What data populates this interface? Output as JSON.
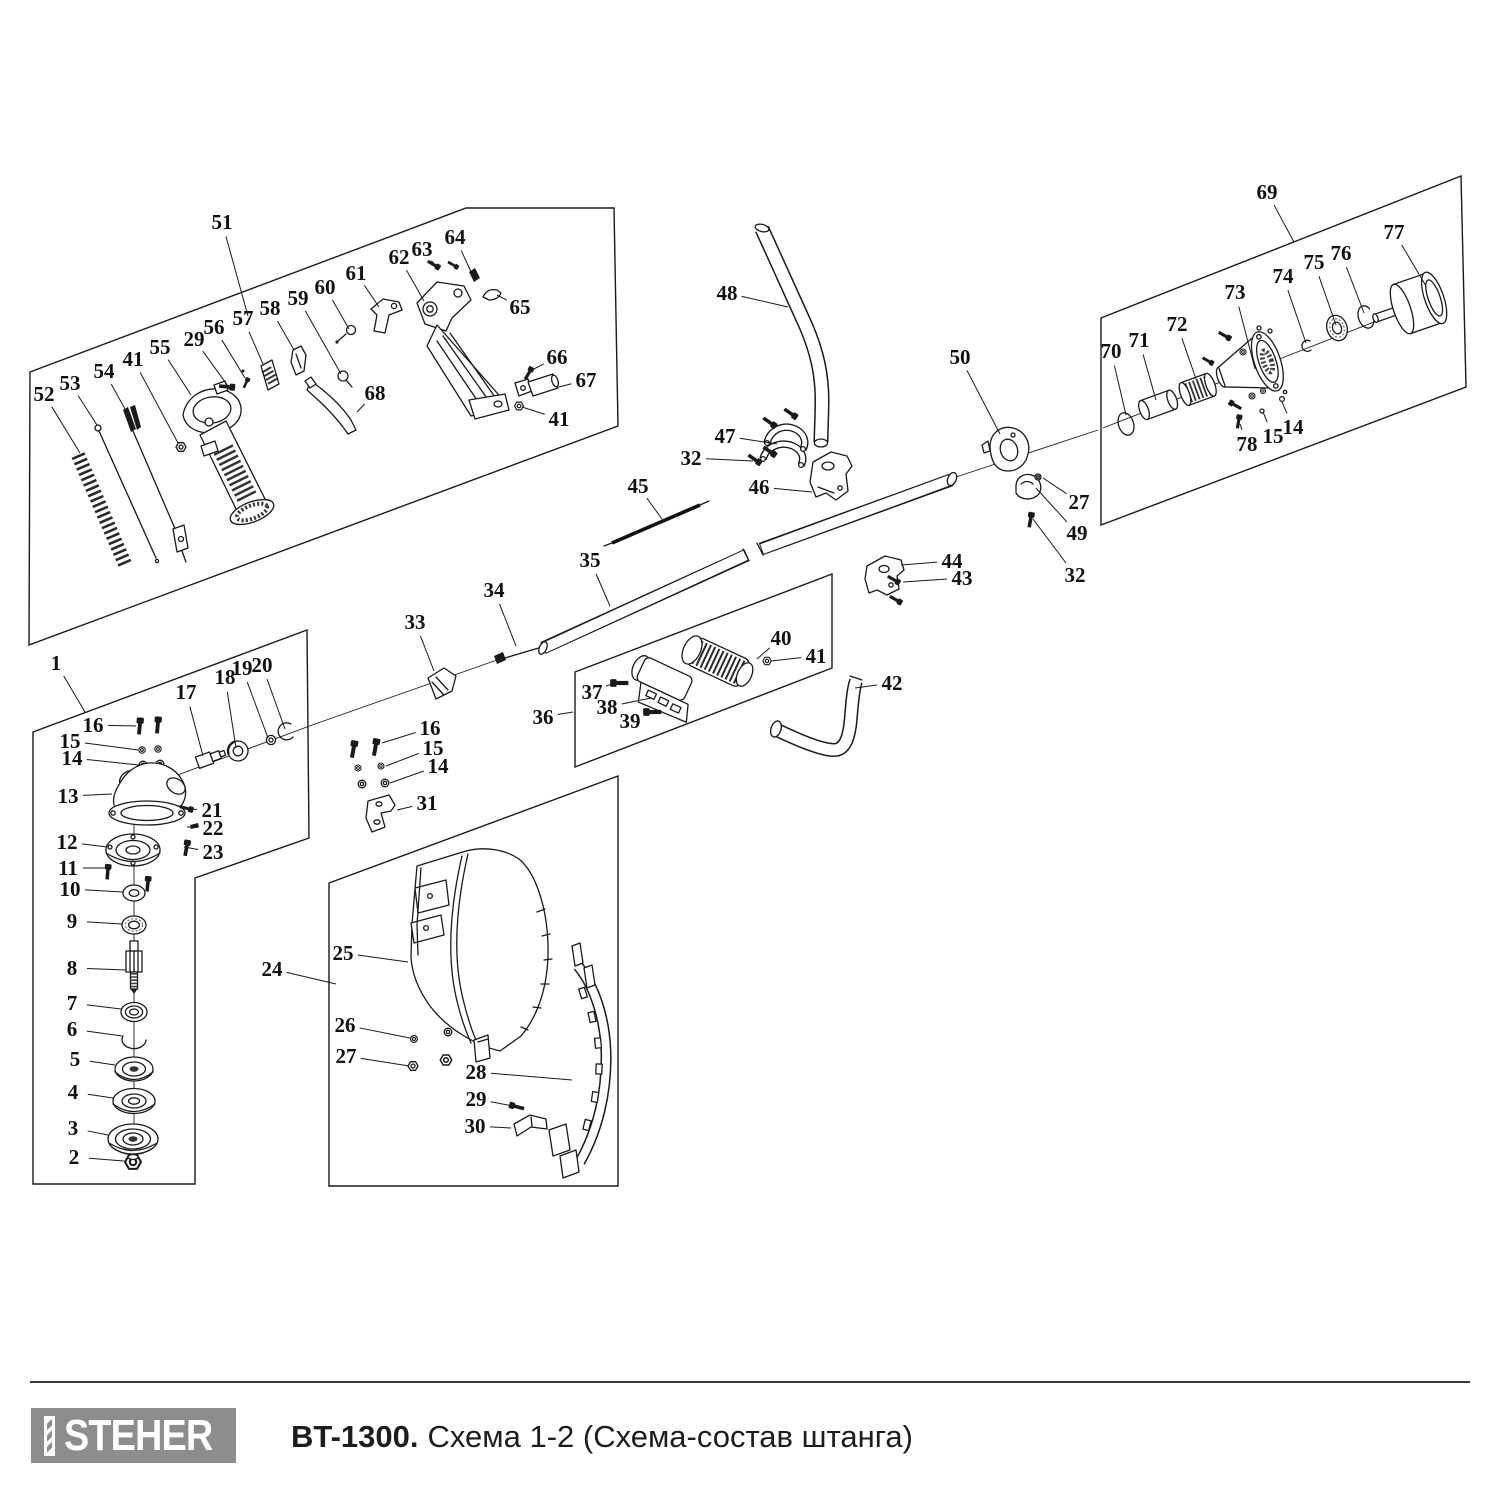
{
  "footer": {
    "brand": "STEHER",
    "model": "BT-1300.",
    "subtitle": "Схема 1-2 (Схема-состав штанга)"
  },
  "colors": {
    "line": "#1a1a1a",
    "logo_bg": "#8d8d8d",
    "label": "#111111"
  },
  "diagram": {
    "boxes": [
      {
        "name": "handle-assembly",
        "points": "30,372 466,208 614,208 618,426 29,645"
      },
      {
        "name": "gearhead-assembly",
        "points": "33,732 307,630 309,838 195,878 195,1184 33,1184"
      },
      {
        "name": "guard-assembly",
        "points": "329,883 618,776 618,1186 329,1186"
      },
      {
        "name": "grip-assembly",
        "points": "575,672 832,574 832,668 575,767"
      },
      {
        "name": "clutch-assembly",
        "points": "1101,318 1461,176 1466,387 1101,525"
      }
    ],
    "axes": [
      "148,786 315,724",
      "315,724 497,660",
      "953,478 1098,430",
      "1103,428 1420,304",
      "134,822 134,1152"
    ],
    "callouts": [
      {
        "t": "51",
        "x": 222,
        "y": 222,
        "tx": 248,
        "ty": 316
      },
      {
        "t": "52",
        "x": 44,
        "y": 394,
        "tx": 80,
        "ty": 453
      },
      {
        "t": "53",
        "x": 70,
        "y": 383,
        "tx": 97,
        "ty": 425
      },
      {
        "t": "54",
        "x": 104,
        "y": 371,
        "tx": 125,
        "ty": 409
      },
      {
        "t": "41",
        "x": 133,
        "y": 359,
        "tx": 178,
        "ty": 443
      },
      {
        "t": "55",
        "x": 160,
        "y": 347,
        "tx": 191,
        "ty": 395
      },
      {
        "t": "29",
        "x": 194,
        "y": 339,
        "tx": 228,
        "ty": 386
      },
      {
        "t": "56",
        "x": 214,
        "y": 327,
        "tx": 245,
        "ty": 378
      },
      {
        "t": "57",
        "x": 243,
        "y": 318,
        "tx": 263,
        "ty": 364
      },
      {
        "t": "58",
        "x": 270,
        "y": 308,
        "tx": 294,
        "ty": 350
      },
      {
        "t": "59",
        "x": 298,
        "y": 298,
        "tx": 341,
        "ty": 374
      },
      {
        "t": "60",
        "x": 325,
        "y": 287,
        "tx": 349,
        "ty": 329
      },
      {
        "t": "61",
        "x": 356,
        "y": 273,
        "tx": 379,
        "ty": 307
      },
      {
        "t": "62",
        "x": 399,
        "y": 257,
        "tx": 424,
        "ty": 301
      },
      {
        "t": "63",
        "x": 422,
        "y": 249,
        "tx": 435,
        "ty": 265
      },
      {
        "t": "64",
        "x": 455,
        "y": 237,
        "tx": 472,
        "ty": 274
      },
      {
        "t": "65",
        "x": 520,
        "y": 307,
        "tx": 497,
        "ty": 295
      },
      {
        "t": "66",
        "x": 557,
        "y": 357,
        "tx": 532,
        "ty": 370
      },
      {
        "t": "67",
        "x": 586,
        "y": 380,
        "tx": 559,
        "ty": 387
      },
      {
        "t": "41",
        "x": 559,
        "y": 419,
        "tx": 522,
        "ty": 407
      },
      {
        "t": "68",
        "x": 375,
        "y": 393,
        "tx": 357,
        "ty": 412
      },
      {
        "t": "1",
        "x": 56,
        "y": 663,
        "tx": 85,
        "ty": 712
      },
      {
        "t": "16",
        "x": 93,
        "y": 725,
        "tx": 136,
        "ty": 726
      },
      {
        "t": "15",
        "x": 70,
        "y": 741,
        "tx": 138,
        "ty": 750
      },
      {
        "t": "14",
        "x": 72,
        "y": 758,
        "tx": 139,
        "ty": 765
      },
      {
        "t": "17",
        "x": 186,
        "y": 692,
        "tx": 203,
        "ty": 756
      },
      {
        "t": "18",
        "x": 225,
        "y": 677,
        "tx": 236,
        "ty": 748
      },
      {
        "t": "19",
        "x": 242,
        "y": 668,
        "tx": 268,
        "ty": 738
      },
      {
        "t": "20",
        "x": 262,
        "y": 665,
        "tx": 285,
        "ty": 729
      },
      {
        "t": "13",
        "x": 68,
        "y": 796,
        "tx": 112,
        "ty": 794
      },
      {
        "t": "21",
        "x": 212,
        "y": 810,
        "tx": 186,
        "ty": 809
      },
      {
        "t": "22",
        "x": 213,
        "y": 828,
        "tx": 187,
        "ty": 827
      },
      {
        "t": "23",
        "x": 213,
        "y": 852,
        "tx": 184,
        "ty": 847
      },
      {
        "t": "12",
        "x": 67,
        "y": 842,
        "tx": 107,
        "ty": 847
      },
      {
        "t": "11",
        "x": 68,
        "y": 868,
        "tx": 105,
        "ty": 868
      },
      {
        "t": "10",
        "x": 70,
        "y": 889,
        "tx": 123,
        "ty": 892
      },
      {
        "t": "9",
        "x": 72,
        "y": 921,
        "tx": 122,
        "ty": 924
      },
      {
        "t": "8",
        "x": 72,
        "y": 968,
        "tx": 126,
        "ty": 970
      },
      {
        "t": "7",
        "x": 72,
        "y": 1003,
        "tx": 121,
        "ty": 1009
      },
      {
        "t": "6",
        "x": 72,
        "y": 1029,
        "tx": 122,
        "ty": 1036
      },
      {
        "t": "5",
        "x": 75,
        "y": 1059,
        "tx": 115,
        "ty": 1065
      },
      {
        "t": "4",
        "x": 73,
        "y": 1092,
        "tx": 113,
        "ty": 1098
      },
      {
        "t": "3",
        "x": 73,
        "y": 1128,
        "tx": 108,
        "ty": 1135
      },
      {
        "t": "2",
        "x": 74,
        "y": 1157,
        "tx": 124,
        "ty": 1161
      },
      {
        "t": "48",
        "x": 727,
        "y": 293,
        "tx": 788,
        "ty": 307
      },
      {
        "t": "45",
        "x": 638,
        "y": 486,
        "tx": 662,
        "ty": 519
      },
      {
        "t": "35",
        "x": 590,
        "y": 560,
        "tx": 610,
        "ty": 606
      },
      {
        "t": "34",
        "x": 494,
        "y": 590,
        "tx": 516,
        "ty": 646
      },
      {
        "t": "33",
        "x": 415,
        "y": 622,
        "tx": 434,
        "ty": 671
      },
      {
        "t": "47",
        "x": 725,
        "y": 436,
        "tx": 777,
        "ty": 444
      },
      {
        "t": "32",
        "x": 691,
        "y": 458,
        "tx": 753,
        "ty": 461
      },
      {
        "t": "46",
        "x": 759,
        "y": 487,
        "tx": 812,
        "ty": 492
      },
      {
        "t": "50",
        "x": 960,
        "y": 357,
        "tx": 1000,
        "ty": 434
      },
      {
        "t": "27",
        "x": 1079,
        "y": 502,
        "tx": 1043,
        "ty": 478
      },
      {
        "t": "49",
        "x": 1077,
        "y": 533,
        "tx": 1036,
        "ty": 488
      },
      {
        "t": "32",
        "x": 1075,
        "y": 575,
        "tx": 1033,
        "ty": 519
      },
      {
        "t": "44",
        "x": 952,
        "y": 561,
        "tx": 901,
        "ty": 565
      },
      {
        "t": "43",
        "x": 962,
        "y": 578,
        "tx": 903,
        "ty": 582
      },
      {
        "t": "42",
        "x": 892,
        "y": 683,
        "tx": 855,
        "ty": 688
      },
      {
        "t": "40",
        "x": 781,
        "y": 638,
        "tx": 757,
        "ty": 659
      },
      {
        "t": "41",
        "x": 816,
        "y": 656,
        "tx": 771,
        "ty": 661
      },
      {
        "t": "37",
        "x": 592,
        "y": 692,
        "tx": 614,
        "ty": 683
      },
      {
        "t": "38",
        "x": 607,
        "y": 707,
        "tx": 651,
        "ty": 698
      },
      {
        "t": "39",
        "x": 630,
        "y": 721,
        "tx": 651,
        "ty": 712
      },
      {
        "t": "36",
        "x": 543,
        "y": 717,
        "tx": 573,
        "ty": 712
      },
      {
        "t": "16",
        "x": 430,
        "y": 728,
        "tx": 382,
        "ty": 743
      },
      {
        "t": "15",
        "x": 433,
        "y": 748,
        "tx": 386,
        "ty": 766
      },
      {
        "t": "14",
        "x": 438,
        "y": 766,
        "tx": 390,
        "ty": 783
      },
      {
        "t": "31",
        "x": 427,
        "y": 803,
        "tx": 397,
        "ty": 810
      },
      {
        "t": "24",
        "x": 272,
        "y": 969,
        "tx": 336,
        "ty": 984
      },
      {
        "t": "25",
        "x": 343,
        "y": 953,
        "tx": 408,
        "ty": 962
      },
      {
        "t": "26",
        "x": 345,
        "y": 1025,
        "tx": 410,
        "ty": 1038
      },
      {
        "t": "27",
        "x": 346,
        "y": 1056,
        "tx": 409,
        "ty": 1066
      },
      {
        "t": "28",
        "x": 476,
        "y": 1072,
        "tx": 572,
        "ty": 1080
      },
      {
        "t": "29",
        "x": 476,
        "y": 1099,
        "tx": 513,
        "ty": 1106
      },
      {
        "t": "30",
        "x": 475,
        "y": 1126,
        "tx": 511,
        "ty": 1128
      },
      {
        "t": "69",
        "x": 1267,
        "y": 192,
        "tx": 1294,
        "ty": 242
      },
      {
        "t": "70",
        "x": 1111,
        "y": 351,
        "tx": 1126,
        "ty": 415
      },
      {
        "t": "71",
        "x": 1139,
        "y": 340,
        "tx": 1156,
        "ty": 400
      },
      {
        "t": "72",
        "x": 1177,
        "y": 324,
        "tx": 1196,
        "ty": 379
      },
      {
        "t": "73",
        "x": 1235,
        "y": 292,
        "tx": 1255,
        "ty": 369
      },
      {
        "t": "74",
        "x": 1283,
        "y": 276,
        "tx": 1306,
        "ty": 343
      },
      {
        "t": "75",
        "x": 1314,
        "y": 262,
        "tx": 1336,
        "ty": 325
      },
      {
        "t": "76",
        "x": 1341,
        "y": 253,
        "tx": 1364,
        "ty": 313
      },
      {
        "t": "77",
        "x": 1394,
        "y": 232,
        "tx": 1426,
        "ty": 286
      },
      {
        "t": "78",
        "x": 1247,
        "y": 444,
        "tx": 1240,
        "ty": 424
      },
      {
        "t": "15",
        "x": 1273,
        "y": 436,
        "tx": 1263,
        "ty": 412
      },
      {
        "t": "14",
        "x": 1293,
        "y": 427,
        "tx": 1282,
        "ty": 402
      }
    ]
  }
}
